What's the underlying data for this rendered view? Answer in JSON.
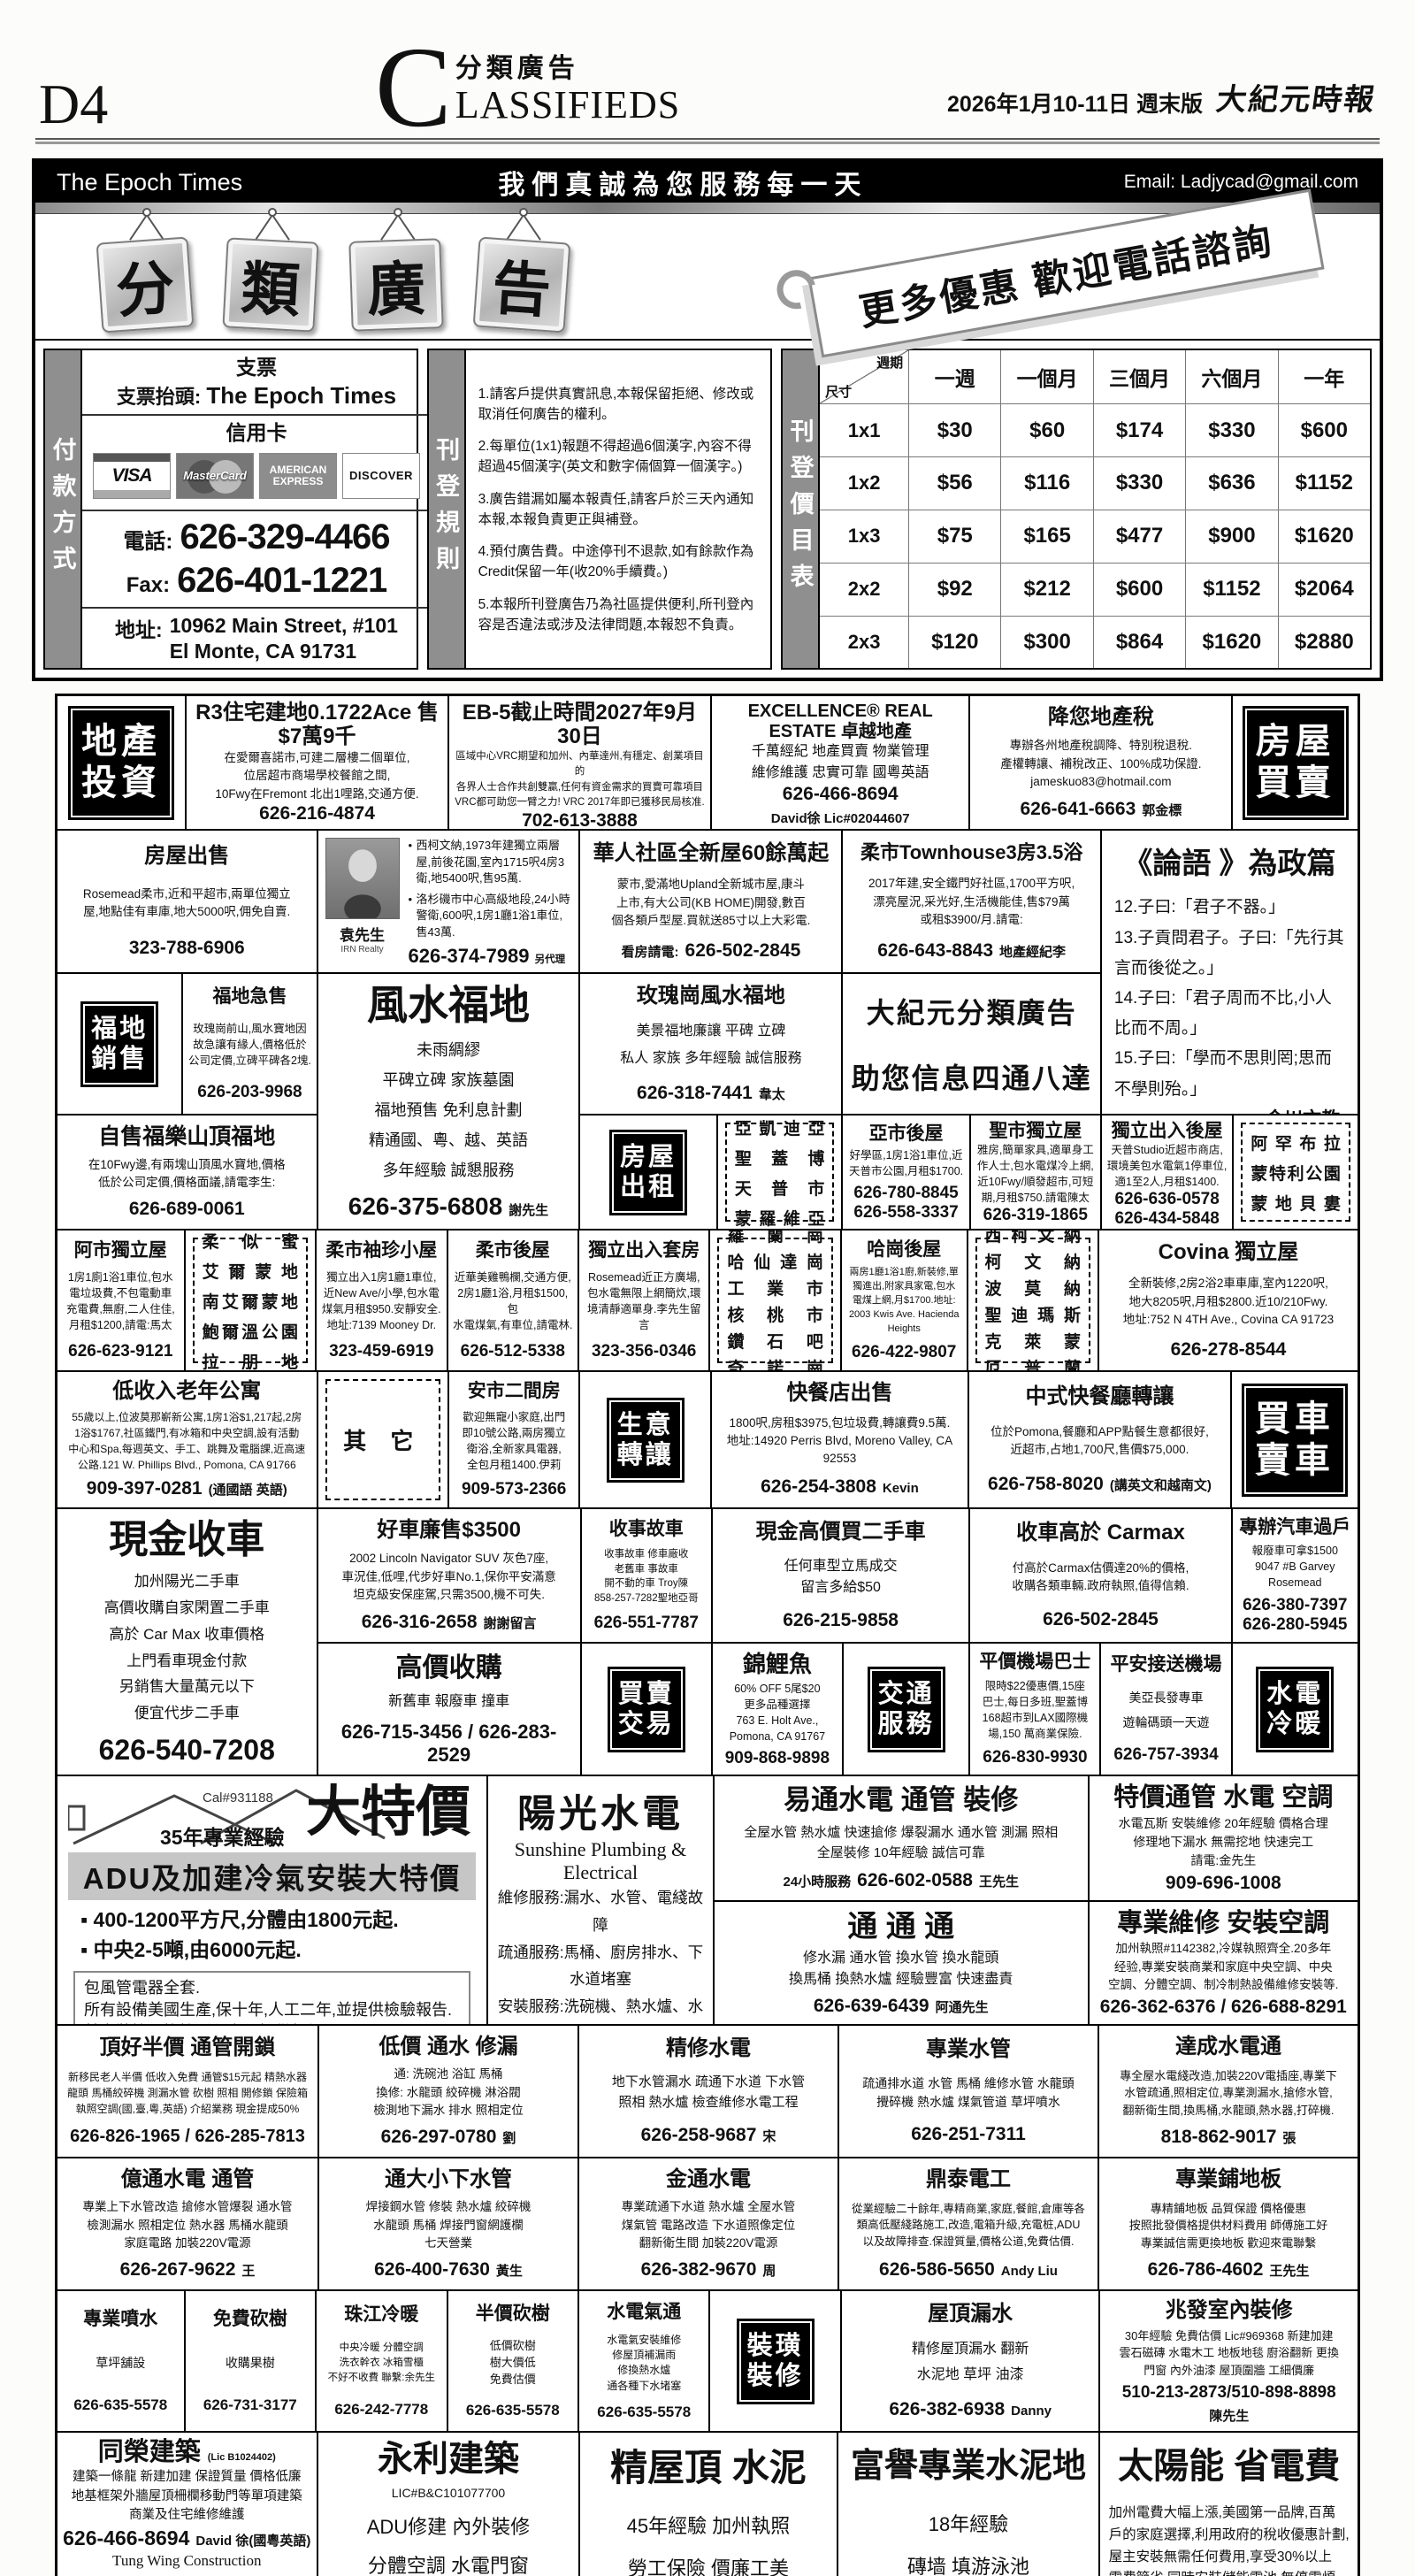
{
  "colors": {
    "ink": "#111111",
    "paper": "#fcfcfa",
    "label_bg": "#000000",
    "bar_gray": "#c6c6c6"
  },
  "header": {
    "page_number": "D4",
    "section_initial": "C",
    "section_cn": "分類廣告",
    "section_en": "LASSIFIEDS",
    "date": "2026年1月10-11日 週末版",
    "paper_name": "大紀元時報"
  },
  "banner": {
    "left": "The Epoch Times",
    "center": "我們真誠為您服務每一天",
    "right": "Email: Ladjycad@gmail.com"
  },
  "masthead": {
    "signs": [
      "分",
      "類",
      "廣",
      "告"
    ],
    "ribbon": "更多優惠 歡迎電話諮詢"
  },
  "payment": {
    "side_label": "付款方式",
    "check_heading": "支票",
    "payee_label": "支票抬頭:",
    "payee": "The Epoch Times",
    "card_heading": "信用卡",
    "cards": [
      "VISA",
      "MasterCard",
      "AMERICAN EXPRESS",
      "DISCOVER"
    ],
    "phone_label": "電話:",
    "phone": "626-329-4466",
    "fax_label": "Fax:",
    "fax": "626-401-1221",
    "address_label": "地址:",
    "address1": "10962 Main Street, #101",
    "address2": "El Monte, CA 91731"
  },
  "rules": {
    "side_label": "刊登規則",
    "items": [
      "1.請客戶提供真實訊息,本報保留拒絕、修改或取消任何廣告的權利。",
      "2.每單位(1x1)報題不得超過6個漢字,內容不得超過45個漢字(英文和數字倆個算一個漢字。)",
      "3.廣告錯漏如屬本報責任,請客戶於三天內通知本報,本報負責更正與補登。",
      "4.預付廣告費。中途停刊不退款,如有餘款作為Credit保留一年(收20%手續費。)",
      "5.本報所刊登廣告乃為社區提供便利,所刊登內容是否違法或涉及法律問題,本報恕不負責。"
    ]
  },
  "pricing": {
    "side_label": "刊登價目表",
    "corner_top": "週期",
    "corner_bottom": "尺寸",
    "columns": [
      "一週",
      "一個月",
      "三個月",
      "六個月",
      "一年"
    ],
    "rows": [
      {
        "size": "1x1",
        "prices": [
          "$30",
          "$60",
          "$174",
          "$330",
          "$600"
        ]
      },
      {
        "size": "1x2",
        "prices": [
          "$56",
          "$116",
          "$330",
          "$636",
          "$1152"
        ]
      },
      {
        "size": "1x3",
        "prices": [
          "$75",
          "$165",
          "$477",
          "$900",
          "$1620"
        ]
      },
      {
        "size": "2x2",
        "prices": [
          "$92",
          "$212",
          "$600",
          "$1152",
          "$2064"
        ]
      },
      {
        "size": "2x3",
        "prices": [
          "$120",
          "$300",
          "$864",
          "$1620",
          "$2880"
        ]
      }
    ]
  },
  "labels": {
    "invest": [
      "地產",
      "投資"
    ],
    "house_sale": [
      "房屋",
      "買賣"
    ],
    "grave": [
      "福地",
      "銷售"
    ],
    "rent": [
      "房屋",
      "出租"
    ],
    "business": [
      "生意",
      "轉讓"
    ],
    "car": [
      "買車",
      "賣車"
    ],
    "trade": [
      "買賣",
      "交易"
    ],
    "transport": [
      "交通",
      "服務"
    ],
    "plumbing": [
      "水電",
      "冷暖"
    ],
    "decor": [
      "裝璜",
      "裝修"
    ]
  },
  "regions": {
    "sgv": [
      "亞凱迪亞",
      "聖蓋博",
      "天普市",
      "蒙羅維亞"
    ],
    "alhambra": [
      "阿罕布拉",
      "蒙特利公園",
      "蒙地貝婁"
    ],
    "rosemead": [
      "柔似蜜",
      "艾爾蒙地",
      "南艾爾蒙地",
      "鮑爾溫公園",
      "拉朋地"
    ],
    "rowland": [
      "羅蘭崗",
      "哈仙達崗",
      "工業市",
      "核桃市",
      "鑽石吧",
      "奇諾崗"
    ],
    "covina": [
      "西柯文納",
      "柯文納",
      "波莫納",
      "聖迪瑪斯",
      "克萊蒙",
      "厄普蘭"
    ],
    "other": [
      "其 它"
    ]
  },
  "ads": {
    "r3": {
      "t": "R3住宅建地0.1722Ace 售$7萬9千",
      "lines": [
        "在愛爾喜諾市,可建二層樓二個單位,",
        "位居超市商場學校餐館之間,",
        "10Fwy在Fremont 北出1哩路,交通方便."
      ],
      "phone": "626-216-4874"
    },
    "eb5": {
      "t": "EB-5截止時間2027年9月30日",
      "lines": [
        "區域中心VRC期望和加州、內華達州,有穩定、創業項目的",
        "各界人士合作共創雙贏,任何有資金需求的買賣可靠項目",
        "VRC都可助您一臂之力! VRC 2017年即已獲移民局核准."
      ],
      "phone": "702-613-3888"
    },
    "excellence": {
      "t": "EXCELLENCE® REAL ESTATE 卓越地產",
      "lines": [
        "千萬經紀 地產買賣 物業管理",
        "維修維護 忠實可靠 國粵英語"
      ],
      "phone": "626-466-8694",
      "sfx": "David徐 Lic#02044607"
    },
    "tax": {
      "t": "降您地產稅",
      "lines": [
        "專辦各州地產稅調降、特別稅退稅.",
        "產權轉讓、補稅改正、100%成功保證.",
        "jameskuo83@hotmail.com"
      ],
      "phone": "626-641-6663",
      "sfx": "郭金標"
    },
    "house_sale1": {
      "t": "房屋出售",
      "lines": [
        "Rosemead柔市,近和平超市,兩單位獨立",
        "屋,地點佳有車庫,地大5000呎,佣免自賣."
      ],
      "phone": "323-788-6906"
    },
    "yuan": {
      "name": "袁先生",
      "company": "IRN Realty",
      "bullets": [
        "西柯文納,1973年建獨立兩層屋,前後花園,室內1715呎4房3衛,地5400呎,售95萬.",
        "洛杉磯市中心高級地段,24小時警衛,600呎,1房1廳1浴1車位,售43萬."
      ],
      "phone": "626-374-7989",
      "sfx": "另代理其它各類房地產買賣"
    },
    "new_homes": {
      "t": "華人社區全新屋60餘萬起",
      "lines": [
        "蒙市,愛滿地Upland全新城市屋,康斗",
        "上市,有大公司(KB HOME)開發,數百",
        "個各類戶型屋.買就送85寸以上大彩電."
      ],
      "pre": "看房請電:",
      "phone": "626-502-2845"
    },
    "townhouse": {
      "t": "柔市Townhouse3房3.5浴",
      "lines": [
        "2017年建,安全鐵門好社區,1700平方呎,",
        "漂亮屋況,采光好,生活機能佳,售$79萬",
        "或租$3900/月.請電:"
      ],
      "phone": "626-643-8843",
      "sfx": "地產經紀李"
    },
    "analects": {
      "t": "《論語 》為政篇",
      "lines": [
        "12.子曰:「君子不器。」",
        "13.子貢問君子。子曰:「先行其言而後從之。」",
        "14.子曰:「君子周而不比,小人比而不周。」",
        "15.子曰:「學而不思則罔;思而不學則殆。」"
      ],
      "sig": "金川文教"
    },
    "grave_urgent": {
      "t": "福地急售",
      "lines": [
        "玫瑰崗前山,風水寶地因",
        "故急讓有緣人,價格低於",
        "公司定價,立碑平碑各2塊."
      ],
      "phone": "626-203-9968"
    },
    "fengshui": {
      "t": "風水福地",
      "lines": [
        "未雨綢繆",
        "平碑立碑 家族墓園",
        "福地預售 免利息計劃",
        "精通國、粵、越、英語",
        "多年經驗 誠懇服務"
      ],
      "phone": "626-375-6808",
      "sfx": "謝先生"
    },
    "rosehills": {
      "t": "玫瑰崗風水福地",
      "lines": [
        "美景福地廉讓 平碑 立碑",
        "私人 家族 多年經驗 誠信服務"
      ],
      "phone": "626-318-7441",
      "sfx": "韋太"
    },
    "house_ad": {
      "lines": [
        "大紀元分類廣告",
        "助您信息四通八達"
      ]
    },
    "self_grave": {
      "t": "自售福樂山頂福地",
      "lines": [
        "在10Fwy邊,有兩塊山頂風水寶地,價格",
        "低於公司定價,價格面議,請電李生:"
      ],
      "phone": "626-689-0061"
    },
    "ya_rear": {
      "t": "亞市後屋",
      "lines": [
        "好學區,1房1浴1車位,近",
        "天普市公園,月租$1700."
      ],
      "phone": "626-780-8845",
      "phone2": "626-558-3337"
    },
    "sg_house": {
      "t": "聖市獨立屋",
      "lines": [
        "雅房,簡單家具,適單身工",
        "作人士,包水電煤冷上網,",
        "近10Fwy/順發超市,可短",
        "期,月租$750.請電陳太"
      ],
      "phone": "626-319-1865"
    },
    "temple_rear": {
      "t": "獨立出入後屋",
      "lines": [
        "天普Studio近超市商店,",
        "環境美包水電氣1停車位,",
        "適1至2人,月租$1400."
      ],
      "phone": "626-636-0578",
      "phone2": "626-434-5848"
    },
    "ah_house": {
      "t": "阿市獨立屋",
      "lines": [
        "1房1廁1浴1車位,包水",
        "電垃圾費,不包電動車",
        "充電費,無廚,二人住佳,",
        "月租$1200,請電:馬太"
      ],
      "phone": "626-623-9121"
    },
    "rm_tiny": {
      "t": "柔市袖珍小屋",
      "lines": [
        "獨立出入1房1廳1車位,",
        "近New Ave/小學,包水電",
        "煤氣月租$950.安靜安全.",
        "地址:7139 Mooney Dr."
      ],
      "phone": "323-459-6919"
    },
    "rm_rear": {
      "t": "柔市後屋",
      "lines": [
        "近華美雞鴨欄,交通方便,",
        "2房1廳1浴,月租$1500,包",
        "水電煤氣,有車位,請電林."
      ],
      "phone": "626-512-5338"
    },
    "suite": {
      "t": "獨立出入套房",
      "lines": [
        "Rosemead近正方廣場,",
        "包水電無限上網簡炊,環",
        "境清靜適單身.李先生留言"
      ],
      "phone": "323-356-0346"
    },
    "hacienda_rear": {
      "t": "哈崗後屋",
      "lines": [
        "兩房1廳1浴1廚,新裝修,單",
        "獨進出,附家具家電,包水",
        "電煤上網,月$1700.地址:",
        "2003 Kwis Ave. Hacienda Heights"
      ],
      "phone": "626-422-9807"
    },
    "covina_house": {
      "t": "Covina 獨立屋",
      "lines": [
        "全新裝修,2房2浴2車車庫,室內1220呎,",
        "地大8205呎,月租$2800.近10/210Fwy.",
        "地址:752 N 4TH Ave., Covina CA 91723"
      ],
      "phone": "626-278-8544"
    },
    "senior_apt": {
      "t": "低收入老年公寓",
      "lines": [
        "55歲以上,位波莫那嶄新公寓,1房1浴$1,217起,2房",
        "1浴$1767,社區鐵門,有冰箱和中央空調,設有活動",
        "中心和Spa,每週英文、手工、跳舞及電腦課,近高速",
        "公路.121 W. Phillips Blvd., Pomona, CA 91766"
      ],
      "phone": "909-397-0281",
      "sfx": "(通國語 英語)"
    },
    "anshi": {
      "t": "安市二間房",
      "lines": [
        "歡迎無寵小家庭,出門",
        "即10號公路,兩房獨立",
        "衛浴,全新家具電器,",
        "全包月租1400.伊莉"
      ],
      "phone": "909-573-2366"
    },
    "fastfood_sale": {
      "t": "快餐店出售",
      "lines": [
        "1800呎,房租$3975,包垃圾費,轉讓費9.5萬.",
        "地址:14920 Perris Blvd, Moreno Valley, CA 92553"
      ],
      "phone": "626-254-3808",
      "sfx": "Kevin"
    },
    "chinese_ff": {
      "t": "中式快餐廳轉讓",
      "lines": [
        "位於Pomona,餐廳和APP點餐生意都很好,",
        "近超市,占地1,700尺,售價$75,000."
      ],
      "phone": "626-758-8020",
      "sfx": "(講英文和越南文)"
    },
    "cash_car": {
      "t": "現金收車",
      "lines": [
        "加州陽光二手車",
        "高價收購自家閑置二手車",
        "高於 Car Max 收車價格",
        "上門看車現金付款",
        "另銷售大量萬元以下",
        "便宜代步二手車"
      ],
      "phone": "626-540-7208"
    },
    "good_car": {
      "t": "好車廉售$3500",
      "lines": [
        "2002 Lincoln Navigator SUV 灰色7座,",
        "車況佳,低哩,代步好車No.1,保你平安滿意",
        "坦克級安保座駕,只需3500,機不可失."
      ],
      "phone": "626-316-2658",
      "sfx": "謝謝留言"
    },
    "accident_car": {
      "t": "收事故車",
      "lines": [
        "收事故車 修車廠收",
        "老舊車 事故車",
        "開不動的車 Troy陳",
        "858-257-7282聖地亞哥"
      ],
      "phone": "626-551-7787"
    },
    "cash_buy": {
      "t": "現金高價買二手車",
      "lines": [
        "任何車型立馬成交",
        "留言多給$50"
      ],
      "phone": "626-215-9858"
    },
    "carmax": {
      "t": "收車高於 Carmax",
      "lines": [
        "付高於Carmax估價達20%的價格,",
        "收購各類車輛.政府執照,值得信賴."
      ],
      "phone": "626-502-2845"
    },
    "transfer": {
      "t": "專辦汽車過戶",
      "lines": [
        "報廢車可拿$1500",
        "9047 #B Garvey Rosemead"
      ],
      "phone": "626-380-7397",
      "phone2": "626-280-5945"
    },
    "high_buy": {
      "t": "高價收購",
      "lines": [
        "新舊車 報廢車 撞車"
      ],
      "phone": "626-715-3456 / 626-283-2529"
    },
    "koi": {
      "t": "錦鯉魚",
      "lines": [
        "60% OFF 5尾$20",
        "更多品種選擇",
        "763 E. Holt Ave.,",
        "Pomona, CA 91767"
      ],
      "phone": "909-868-9898"
    },
    "airport_bus": {
      "t": "平價機場巴士",
      "lines": [
        "限時$22優惠價,15座",
        "巴士,每日多班,聖蓋博",
        "168超市到LAX國際機",
        "場,150 萬商業保險."
      ],
      "phone": "626-830-9930"
    },
    "airport_car": {
      "t": "平安接送機場",
      "lines": [
        "美亞長發專車",
        "遊輪碼頭一天遊"
      ],
      "phone": "626-757-3934"
    },
    "big_sale": {
      "lic": "Cal#931188",
      "exp": "35年專業經驗",
      "t": "大特價",
      "bar": "ADU及加建冷氣安裝大特價",
      "bullets": [
        "400-1200平方尺,分體由1800元起.",
        "中央2-5噸,由6000元起."
      ],
      "box": [
        "包風管電器全套.",
        "所有設備美國生產,保十年,人工二年,並提供檢驗報告.",
        "其它裝機及換機工程亦可提供報價."
      ],
      "phone": "626-524-5223 / 626-295-3503"
    },
    "sunshine": {
      "t": "陽光水電",
      "sub": "Sunshine Plumbing & Electrical",
      "lines": [
        "維修服務:漏水、水管、電綫故障",
        "疏通服務:馬桶、廚房排水、下水道堵塞",
        "安裝服務:洗碗機、熱水爐、水龍頭等",
        "誠信服務 價格合理",
        "Reliable & Professional Service",
        "周師傅 Master Zhou"
      ],
      "phone": "626-750-6678"
    },
    "yitong": {
      "t": "易通水電 通管 裝修",
      "lines": [
        "全屋水管 熱水爐 快速搶修 爆裂漏水 通水管 測漏 照相",
        "全屋裝修 10年經驗 誠信可靠"
      ],
      "pre": "24小時服務",
      "phone": "626-602-0588",
      "sfx": "王先生"
    },
    "special_pipe": {
      "t": "特價通管 水電 空調",
      "lines": [
        "水電瓦斯 安裝維修 20年經驗 價格合理",
        "修理地下漏水 無需挖地 快速完工",
        "請電:金先生"
      ],
      "phone": "909-696-1008"
    },
    "tong3": {
      "t": "通 通 通",
      "lines": [
        "修水漏 通水管 換水管 換水龍頭",
        "換馬桶 換熱水爐 經驗豐富 快速盡責"
      ],
      "phone": "626-639-6439",
      "sfx": "阿通先生"
    },
    "pro_ac": {
      "t": "專業維修 安裝空調",
      "lines": [
        "加州執照#1142382,冷媒執照齊全.20多年",
        "经验,專業安裝商業和家庭中央空調、中央",
        "空調、分體空調、制冷制熱設備維修安裝等."
      ],
      "phone": "626-362-6376 / 626-688-8291"
    },
    "dinghao": {
      "t": "頂好半價 通管開鎖",
      "lines": [
        "新移民老人半價 低收入免費 通管$15元起 精熱水器",
        "龍頭 馬桶絞碎機 測漏水管 砍樹 照相 開修鎖 保險箱",
        "執照空調(國,臺,粵,英語) 介紹業務 現金提成50%"
      ],
      "phone": "626-826-1965 / 626-285-7813"
    },
    "cheap_fix": {
      "t": "低價 通水 修漏",
      "lines": [
        "通: 洗碗池 浴缸 馬桶",
        "換修: 水龍頭 絞碎機 淋浴閥",
        "檢測地下漏水 排水 照相定位"
      ],
      "phone": "626-297-0780",
      "sfx": "劉"
    },
    "jingxiu": {
      "t": "精修水電",
      "lines": [
        "地下水管漏水 疏通下水道 下水管",
        "照相 熱水爐 檢查維修水電工程"
      ],
      "phone": "626-258-9687",
      "sfx": "宋"
    },
    "pro_pipe": {
      "t": "專業水管",
      "lines": [
        "疏通排水道 水管 馬桶 維修水管 水龍頭",
        "攪碎機 熱水爐 煤氣管道 草坪噴水"
      ],
      "phone": "626-251-7311"
    },
    "dacheng": {
      "t": "達成水電通",
      "lines": [
        "專全屋水電綫改造,加裝220V電插座,專業下",
        "水管疏通,照相定位,專業測漏水,搶修水管,",
        "翻新衛生間,換馬桶,水龍頭,熱水器,打碎機."
      ],
      "phone": "818-862-9017",
      "sfx": "張"
    },
    "yitong2": {
      "t": "億通水電 通管",
      "lines": [
        "專業上下水管改造 搶修水管爆裂 通水管",
        "檢測漏水 照相定位 熱水器 馬桶水龍頭",
        "家庭電路 加裝220V電源"
      ],
      "phone": "626-267-9622",
      "sfx": "王"
    },
    "tongda": {
      "t": "通大小下水管",
      "lines": [
        "焊接鋼水管 修裝 熱水爐 絞碎機",
        "水龍頭 馬桶 焊接門窗網護欄",
        "七天營業"
      ],
      "phone": "626-400-7630",
      "sfx": "黃生"
    },
    "jintong": {
      "t": "金通水電",
      "lines": [
        "專業疏通下水道 熱水爐 全屋水管",
        "煤氣管 電路改造 下水道照像定位",
        "翻新衛生間 加裝220V電源"
      ],
      "phone": "626-382-9670",
      "sfx": "周"
    },
    "dingtai": {
      "t": "鼎泰電工",
      "lines": [
        "從業經驗二十餘年,專精商業,家庭,餐館,倉庫等各",
        "類高低壓綫路施工,改造,電箱升級,充電桩,ADU",
        "以及故障排查.保證質量,價格公道,免費估價."
      ],
      "phone": "626-586-5650",
      "sfx": "Andy Liu"
    },
    "flooring": {
      "t": "專業鋪地板",
      "lines": [
        "專精鋪地板 品質保證 價格優惠",
        "按照批發價格提供材料費用 師傅施工好",
        "專業誠信需更換地板 歡迎來電聯繫"
      ],
      "phone": "626-786-4602",
      "sfx": "王先生"
    },
    "sprinkler": {
      "t": "專業噴水",
      "lines": [
        "草坪舖設"
      ],
      "phone": "626-635-5578"
    },
    "free_tree": {
      "t": "免費砍樹",
      "lines": [
        "收購果樹"
      ],
      "phone": "626-731-3177"
    },
    "zhujiang": {
      "t": "珠江冷暖",
      "lines": [
        "中央冷暖 分體空調",
        "洗衣幹衣 冰箱雪櫃",
        "不好不收費 聯繫:余先生"
      ],
      "phone": "626-242-7778"
    },
    "half_tree": {
      "t": "半價砍樹",
      "lines": [
        "低價砍樹",
        "樹大價低",
        "免費估價"
      ],
      "phone": "626-635-5578"
    },
    "utility": {
      "t": "水電氣通",
      "lines": [
        "水電氣安裝維修",
        "修屋頂補漏雨",
        "修換熱水爐",
        "通各種下水堵塞"
      ],
      "phone": "626-635-5578"
    },
    "roof_leak": {
      "t": "屋頂漏水",
      "lines": [
        "精修屋頂漏水 翻新",
        "水泥地 草坪 油漆"
      ],
      "phone": "626-382-6938",
      "sfx": "Danny"
    },
    "zhaofa": {
      "t": "兆發室內裝修",
      "lines": [
        "30年經驗 免費估價 Lic#969368 新建加建",
        "雲石磁磚 水電木工 地板地毯 廚浴翻新 更換",
        "門窗 內外油漆 屋頂圍牆 工細價廉"
      ],
      "phone": "510-213-2873/510-898-8898",
      "sfx": "陳先生"
    },
    "tongrong": {
      "t": "同榮建築",
      "lic": "(Lic B1024402)",
      "lines": [
        "建築一條龍 新建加建 保證質量 價格低廉",
        "地基框架外牆屋頂柵欄移動門等單項建築",
        "商業及住宅維修維護"
      ],
      "phone": "626-466-8694",
      "sfx": "David 徐(國粵英語)",
      "en": [
        "Tung Wing Construction",
        "New Building Or ADU",
        "Good Quality! Good Price!"
      ],
      "addr": [
        "10423 Valley Blvd #M, El Monte, CA 91731",
        "E-mail: tungwingit@hotmail.com",
        "Fax: 626-573-8518"
      ]
    },
    "yongli": {
      "t": "永利建築",
      "sub": "LIC#B&C101077700",
      "lines": [
        "ADU修建 內外裝修",
        "分體空調 水電門窗",
        "加州執照 百萬保險"
      ],
      "phone": "626-476-5407",
      "sfx": "(中)",
      "phone2": "626-537-0068",
      "sfx2": "(英)"
    },
    "roof_cement": {
      "t": "精屋頂 水泥",
      "lines": [
        "45年經驗 加州執照",
        "勞工保險 價廉工美",
        "專做大小工程 水泥地"
      ],
      "phone": "626-215-6686"
    },
    "fuyu": {
      "t": "富譽專業水泥地",
      "lines": [
        "18年經驗",
        "磚墙 填游泳池",
        "木围墙 塑料塑木围墙"
      ],
      "phone": "626-899-8007",
      "sfx": "方"
    },
    "solar": {
      "t": "太陽能 省電費",
      "lines": [
        "加州電費大幅上漲,美國第一品牌,百萬",
        "戶的家庭選擇,利用政府的稅收優惠計劃,",
        "屋主安裝無需任何費用,享受30%以上",
        "電費節省,同時安裝儲能電池.無停電煩",
        "惱.如您是屋主,您的房子有游泳池、電動",
        "車、大房子,請來電諮詢是否符合安裝."
      ],
      "phone": "626-786-4602"
    }
  }
}
